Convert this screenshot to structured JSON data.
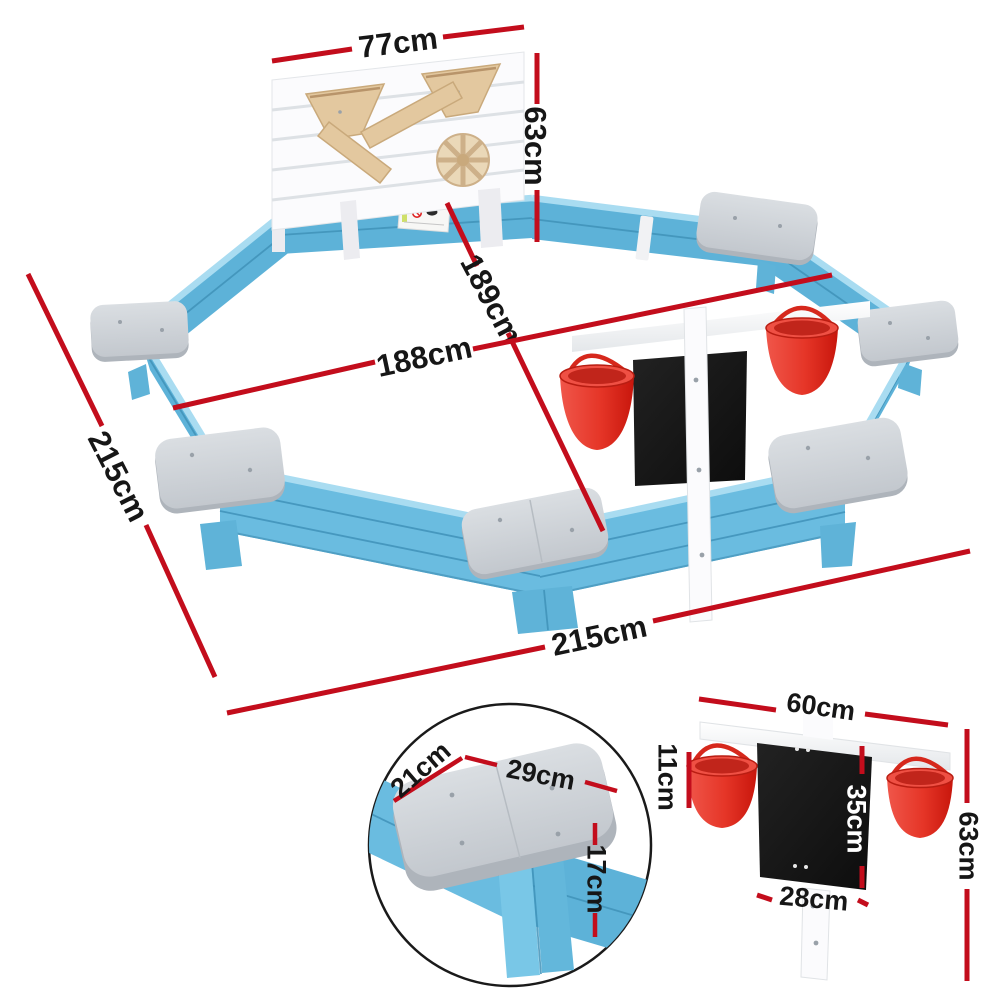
{
  "image": {
    "kind": "product-dimension-diagram"
  },
  "colors": {
    "dim_red": "#c30d1c",
    "label_ink": "#161616",
    "wall_blue": "#6abce0",
    "wall_blue_inner": "#5db2d8",
    "wall_blue_light": "#a9dcf1",
    "wall_blue_dark": "#3f92b8",
    "seat_grey": "#ccd1d6",
    "seat_grey_dark": "#aeb4bb",
    "bucket_red": "#e8372b",
    "chalkboard": "#181818",
    "wood": "#e3c89f",
    "panel_white": "#fbfbfd"
  },
  "labels": {
    "main": {
      "panel_width": "77cm",
      "panel_height": "63cm",
      "diagonal": "189cm",
      "inner_width": "188cm",
      "side_length": "215cm",
      "overall_width": "215cm"
    },
    "seat_detail": {
      "depth": "21cm",
      "width": "29cm",
      "height": "17cm"
    },
    "board_detail": {
      "rail_width": "60cm",
      "bucket_height": "11cm",
      "board_height": "35cm",
      "total_height": "63cm",
      "board_width": "28cm"
    }
  }
}
